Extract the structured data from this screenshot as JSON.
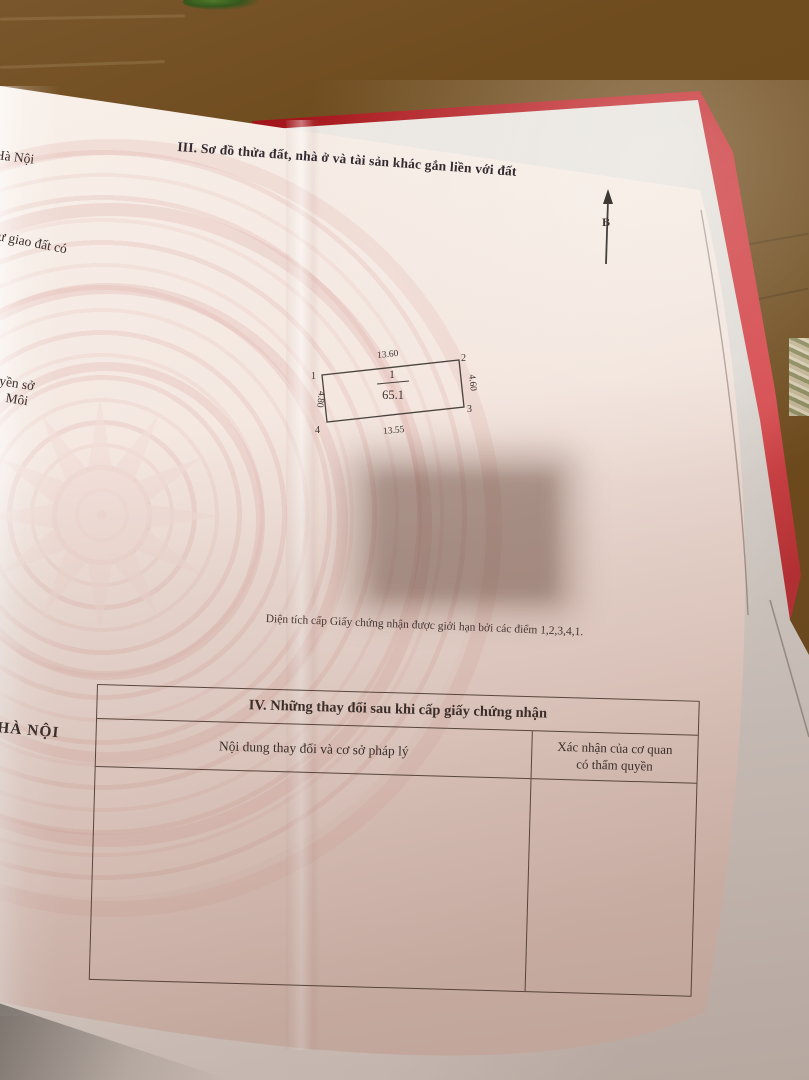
{
  "page": {
    "section3_title": "III. Sơ đồ thửa đất, nhà ở và tài sản khác gắn liền với đất",
    "compass_label": "B",
    "parcel": {
      "number": "1",
      "area": "65.1",
      "corner_1": "1",
      "corner_2": "2",
      "corner_3": "3",
      "corner_4": "4",
      "dim_top": "13.60",
      "dim_right": "4.60",
      "dim_bottom": "13.55",
      "dim_left": "4.80"
    },
    "boundary_note": "Diện tích cấp Giấy chứng nhận được giới hạn bởi các điểm 1,2,3,4,1.",
    "section4": {
      "title": "IV. Những thay đổi sau khi cấp giấy chứng nhận",
      "col1": "Nội dung thay đổi và cơ sở pháp lý",
      "col2_line1": "Xác nhận của cơ quan",
      "col2_line2": "có thẩm quyền"
    },
    "left_page_fragments": {
      "f1": "Hà Nội",
      "f2": "hư giao đất có",
      "f3": "uyền sở",
      "f4": "Môi",
      "f5": "HÀ NỘI"
    }
  },
  "colors": {
    "box_red": "#bf2026",
    "floor_brown": "#6b4819",
    "paper_cream": "#f4e9e1",
    "emblem_pink": "#e3b6b0",
    "ink": "#3a2e2a"
  }
}
